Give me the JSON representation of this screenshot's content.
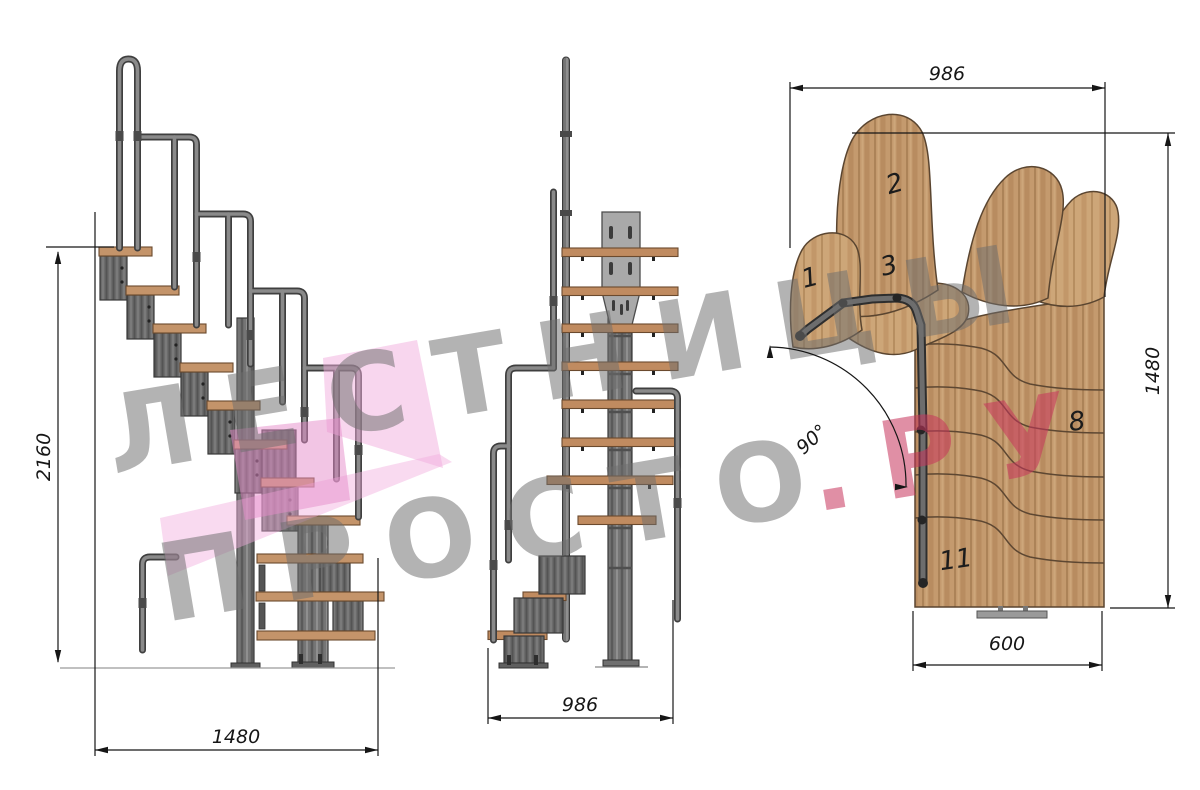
{
  "drawing": {
    "type": "modular staircase technical drawing, three views",
    "watermark": {
      "line1": "ЛЕСТНИЦЫ",
      "line2_gray": "ПРОСТО",
      "line2_red": ".РУ"
    },
    "side_view": {
      "height_label": "2160",
      "width_label": "1480"
    },
    "front_view": {
      "width_label": "986"
    },
    "plan_view": {
      "top_label": "986",
      "right_label": "1480",
      "bottom_label": "600",
      "angle_label": "90°",
      "tread_numbers": {
        "t1": "1",
        "t2": "2",
        "t3": "3",
        "t8": "8",
        "t11": "11"
      }
    },
    "colors": {
      "wood": "#c49a6e",
      "wood_dark": "#6b4a2e",
      "metal": "#6c6c6c",
      "metal_dark": "#3f3f3f",
      "rail": "#848484",
      "plate": "#a9a9a9",
      "dimension": "#161616",
      "watermark_gray": "#6f6f6f",
      "watermark_red": "#c8355c",
      "ribbon_pink": "#f2aede"
    }
  }
}
